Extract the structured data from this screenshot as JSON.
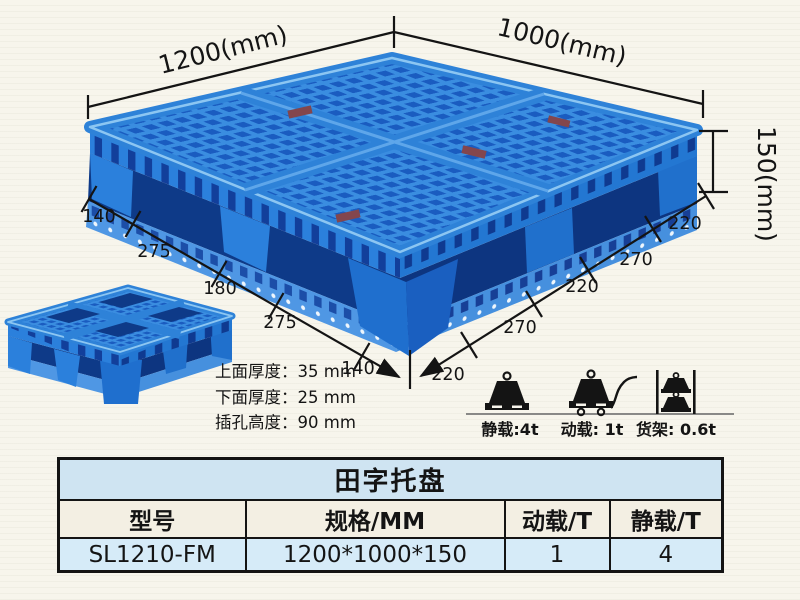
{
  "colors": {
    "pallet_blue": "#2f86dc",
    "pallet_hole_blue": "#1a5cc0",
    "pallet_dark_blue": "#0e3a88",
    "dimension_ink": "#141414",
    "table_title_bg": "#cfe4f2",
    "table_header_bg": "#f3efe3",
    "table_data_bg": "#d6ebf8",
    "background": "#f7f5ec"
  },
  "figure": {
    "dims": {
      "top_left": "1200(mm)",
      "top_right": "1000(mm)",
      "height": "150(mm)",
      "left_edge": [
        "140",
        "275",
        "180",
        "275",
        "140"
      ],
      "right_edge": [
        "220",
        "270",
        "220",
        "270",
        "220"
      ]
    },
    "notes": [
      "上面厚度：35 mm",
      "下面厚度：25 mm",
      "插孔高度：90 mm"
    ],
    "loads": [
      {
        "icon": "static-load-weight-icon",
        "label": "静载:4t"
      },
      {
        "icon": "dynamic-load-trolley-icon",
        "label": "动载: 1t"
      },
      {
        "icon": "rack-load-shelf-icon",
        "label": "货架: 0.6t"
      }
    ]
  },
  "table": {
    "title": "田字托盘",
    "headers": [
      "型号",
      "规格/MM",
      "动载/T",
      "静载/T"
    ],
    "rows": [
      [
        "SL1210-FM",
        "1200*1000*150",
        "1",
        "4"
      ]
    ]
  }
}
